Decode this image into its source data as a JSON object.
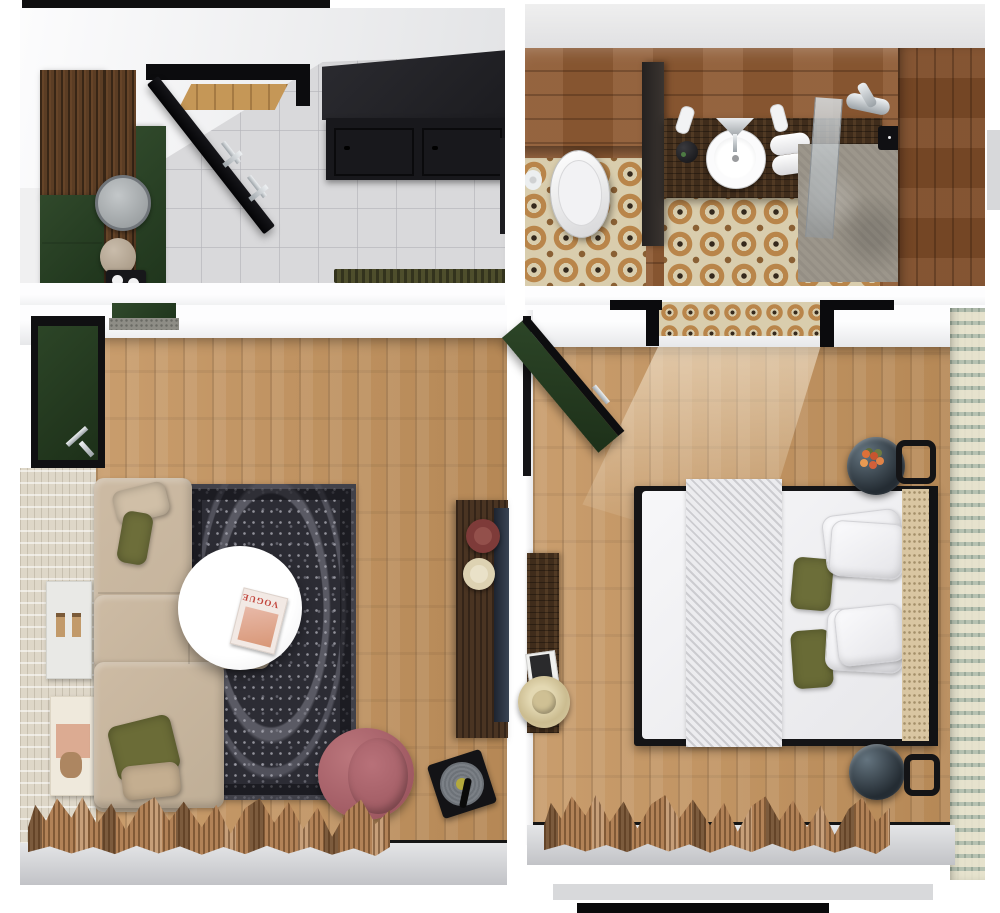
{
  "scene": {
    "kind": "3d-floor-plan-top-view",
    "width": 1000,
    "height": 913
  },
  "magazine": {
    "title": "VOGUE"
  },
  "palette": {
    "wood_floor": "#c3925c",
    "bath_wood": "#8e5a33",
    "vanity_wood": "#3f2c1b",
    "cabinet_black": "#1a1a1e",
    "forest_green": "#2b4226",
    "sofa_beige": "#c7b59d",
    "pillow_olive": "#6c6e39",
    "pillow_tan": "#c4ae90",
    "rug_charcoal": "#2c2c34",
    "armchair_mauve": "#a96067",
    "curtain_tan": "#b28257",
    "bed_white": "#f2f2f4",
    "headboard_cane": "#d9c6a2",
    "glass_table": "#2c353d",
    "wallpaper_sage": "#b6c1b1",
    "tile_grey": "#d9d9db",
    "tile_beige": "#d9cdad",
    "stone_grey": "#9c968b",
    "doormat_olive": "#4e4e2c",
    "plate_maroon": "#7e3b39",
    "plate_cream": "#ddd2b2",
    "vinyl_record": "#70767c",
    "magazine_accent": "#c2453c"
  },
  "rooms": [
    {
      "id": "entry-kitchen",
      "label": "Entry / Kitchen",
      "items": [
        "entry-door",
        "wood-wardrobe",
        "green-cabinets",
        "round-mirror",
        "vase",
        "tray-with-cups",
        "black-kitchen-cabinets",
        "doormat",
        "grey-tile-floor"
      ]
    },
    {
      "id": "bathroom",
      "label": "Bathroom",
      "items": [
        "toilet",
        "toilet-paper-roll",
        "vanity-counter",
        "round-sink",
        "faucet",
        "soap-dispensers",
        "towels",
        "black-jar",
        "glass-partition",
        "shower-floor",
        "shower-mixer",
        "control-panel",
        "moroccan-tile-floor",
        "wood-walls"
      ]
    },
    {
      "id": "living-room",
      "label": "Living Room",
      "items": [
        "green-entry-door",
        "entry-console",
        "sectional-sofa",
        "olive-cushions",
        "tan-cushion",
        "vintage-rug",
        "round-coffee-table",
        "fashion-magazine",
        "mauve-armchair",
        "record-player",
        "wood-sideboard",
        "decorative-plates",
        "wall-tv",
        "wall-art-frames",
        "textured-wall",
        "window-curtains"
      ]
    },
    {
      "id": "bedroom",
      "label": "Bedroom",
      "items": [
        "green-door",
        "bathroom-doorway",
        "double-bed",
        "knit-throw",
        "white-pillows",
        "olive-pillows",
        "cane-headboard",
        "glass-nightstands",
        "flower-bouquet",
        "wall-sconces",
        "wall-console",
        "straw-hat",
        "magazine",
        "sage-wallpaper-wall",
        "window-curtains"
      ]
    }
  ]
}
